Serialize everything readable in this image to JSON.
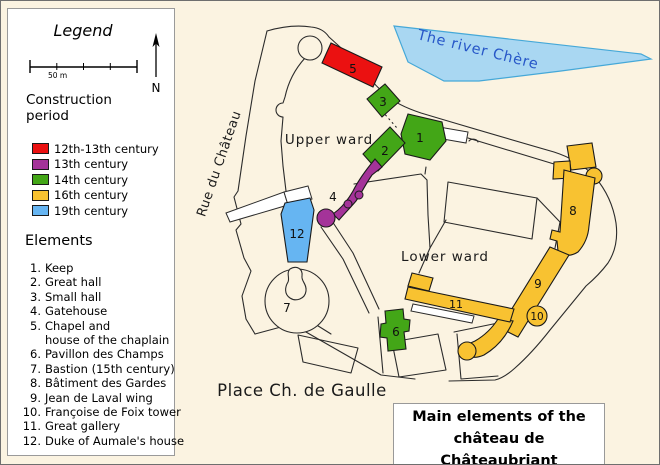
{
  "colors": {
    "c12_13": "#EB1111",
    "c13": "#A43399",
    "c14": "#43A617",
    "c16": "#F8C231",
    "c19": "#66B5F2",
    "river_fill": "#A9D7F2",
    "river_stroke": "#45A8D8",
    "river_text": "#2757C8",
    "background": "#FBF3E1",
    "line": "#2B2B2B"
  },
  "legend": {
    "title": "Legend",
    "scale_label": "50 m",
    "north_label": "N",
    "construction_heading": "Construction period",
    "periods": [
      {
        "label": "12th-13th century",
        "color": "#EB1111"
      },
      {
        "label": "13th century",
        "color": "#A43399"
      },
      {
        "label": "14th century",
        "color": "#43A617"
      },
      {
        "label": "16th century",
        "color": "#F8C231"
      },
      {
        "label": "19th century",
        "color": "#66B5F2"
      }
    ],
    "elements_heading": "Elements",
    "elements": [
      {
        "num": "1.",
        "label": "Keep"
      },
      {
        "num": "2.",
        "label": "Great hall"
      },
      {
        "num": "3.",
        "label": "Small hall"
      },
      {
        "num": "4.",
        "label": "Gatehouse"
      },
      {
        "num": "5.",
        "label": "Chapel and",
        "label2": "house of the chaplain"
      },
      {
        "num": "6.",
        "label": "Pavillon des Champs"
      },
      {
        "num": "7.",
        "label": "Bastion (15th century)"
      },
      {
        "num": "8.",
        "label": "Bâtiment des Gardes"
      },
      {
        "num": "9.",
        "label": "Jean de Laval wing"
      },
      {
        "num": "10.",
        "label": "Françoise de Foix tower"
      },
      {
        "num": "11.",
        "label": "Great gallery"
      },
      {
        "num": "12.",
        "label": "Duke of Aumale's house"
      }
    ]
  },
  "map": {
    "labels": {
      "upper_ward": "Upper ward",
      "lower_ward": "Lower ward",
      "street": "Rue du Château",
      "plaza": "Place Ch. de Gaulle",
      "river": "The river Chère"
    },
    "markers": [
      "1",
      "2",
      "3",
      "4",
      "5",
      "6",
      "7",
      "8",
      "9",
      "10",
      "11",
      "12"
    ]
  },
  "title_box": {
    "line1": "Main elements of the",
    "line2": "château de Châteaubriant"
  }
}
